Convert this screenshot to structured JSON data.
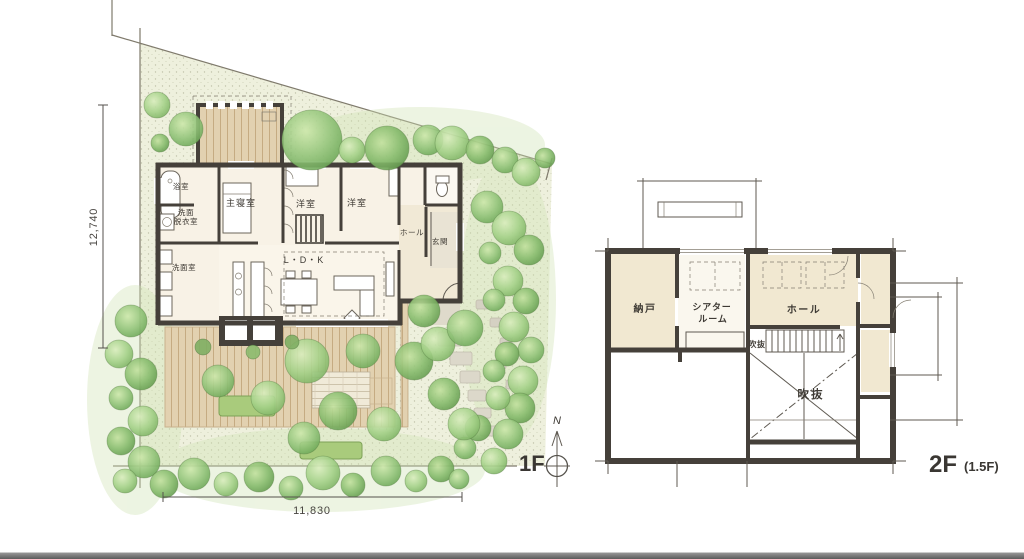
{
  "floor1": {
    "label": "1F",
    "dim_height": "12,740",
    "dim_width": "11,830",
    "compass_n": "N",
    "rooms": {
      "bath": "浴室",
      "wash1": "洗面",
      "wash2": "脱衣室",
      "powder": "洗面室",
      "master": "主寝室",
      "west1": "洋室",
      "west2": "洋室",
      "hall": "ホール",
      "entrance": "玄関",
      "ldk": "L・D・K"
    }
  },
  "floor2": {
    "label": "2F",
    "sublabel": "(1.5F)",
    "rooms": {
      "storage": "納戸",
      "theater1": "シアター",
      "theater2": "ルーム",
      "hall": "ホール",
      "void_small": "吹抜",
      "void_large": "吹抜"
    }
  },
  "colors": {
    "wall": "#45403a",
    "site": "#eef0dd",
    "deck": "#e2d1b0",
    "room_beige": "#f1e8d1",
    "tree_green": "#93c47a",
    "footer_light": "#9a9a9a",
    "footer_dark": "#5c5c5c"
  }
}
